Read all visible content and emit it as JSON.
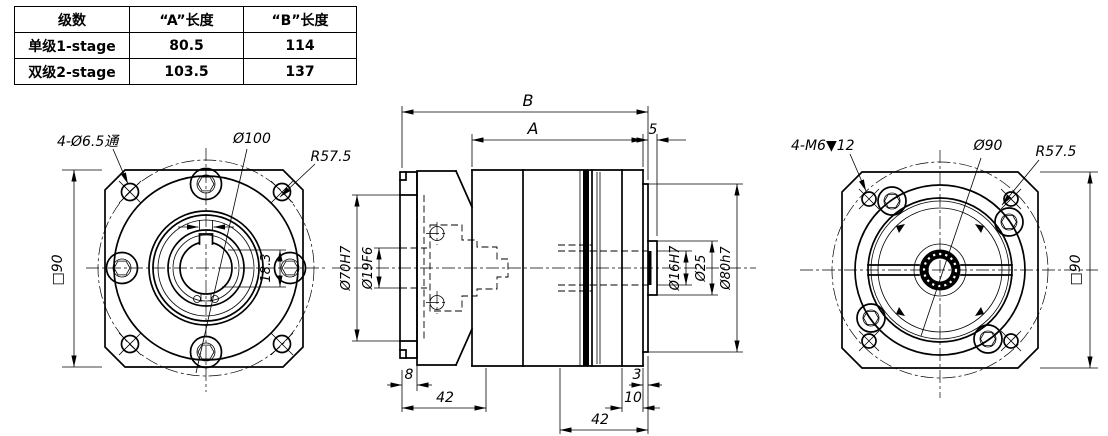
{
  "table": {
    "headers": [
      "级数",
      "“A”长度",
      "“B”长度"
    ],
    "rows": [
      [
        "单级1-stage",
        "80.5",
        "114"
      ],
      [
        "双级2-stage",
        "103.5",
        "137"
      ]
    ]
  },
  "front_view": {
    "corner_holes": "4-Ø6.5通",
    "bolt_circle": "Ø100",
    "corner_radius": "R57.5",
    "frame_size": "□90",
    "keyway_height": "18.3"
  },
  "side_view": {
    "overall_length": "B",
    "body_length": "A",
    "boss_protrusion": "5",
    "input_pilot_dia": "Ø70H7",
    "input_bore_dia": "Ø19F6",
    "input_pilot_depth": "8",
    "input_section_length": "42",
    "output_bore_dia": "Ø16H7",
    "boss_dia": "Ø25",
    "output_pilot_dia": "Ø80h7",
    "plate_step": "3",
    "flange_thickness": "10",
    "output_section_length": "42"
  },
  "rear_view": {
    "tapped_holes": "4-M6▼12",
    "bolt_circle": "Ø90",
    "corner_radius": "R57.5",
    "frame_size": "□90"
  }
}
